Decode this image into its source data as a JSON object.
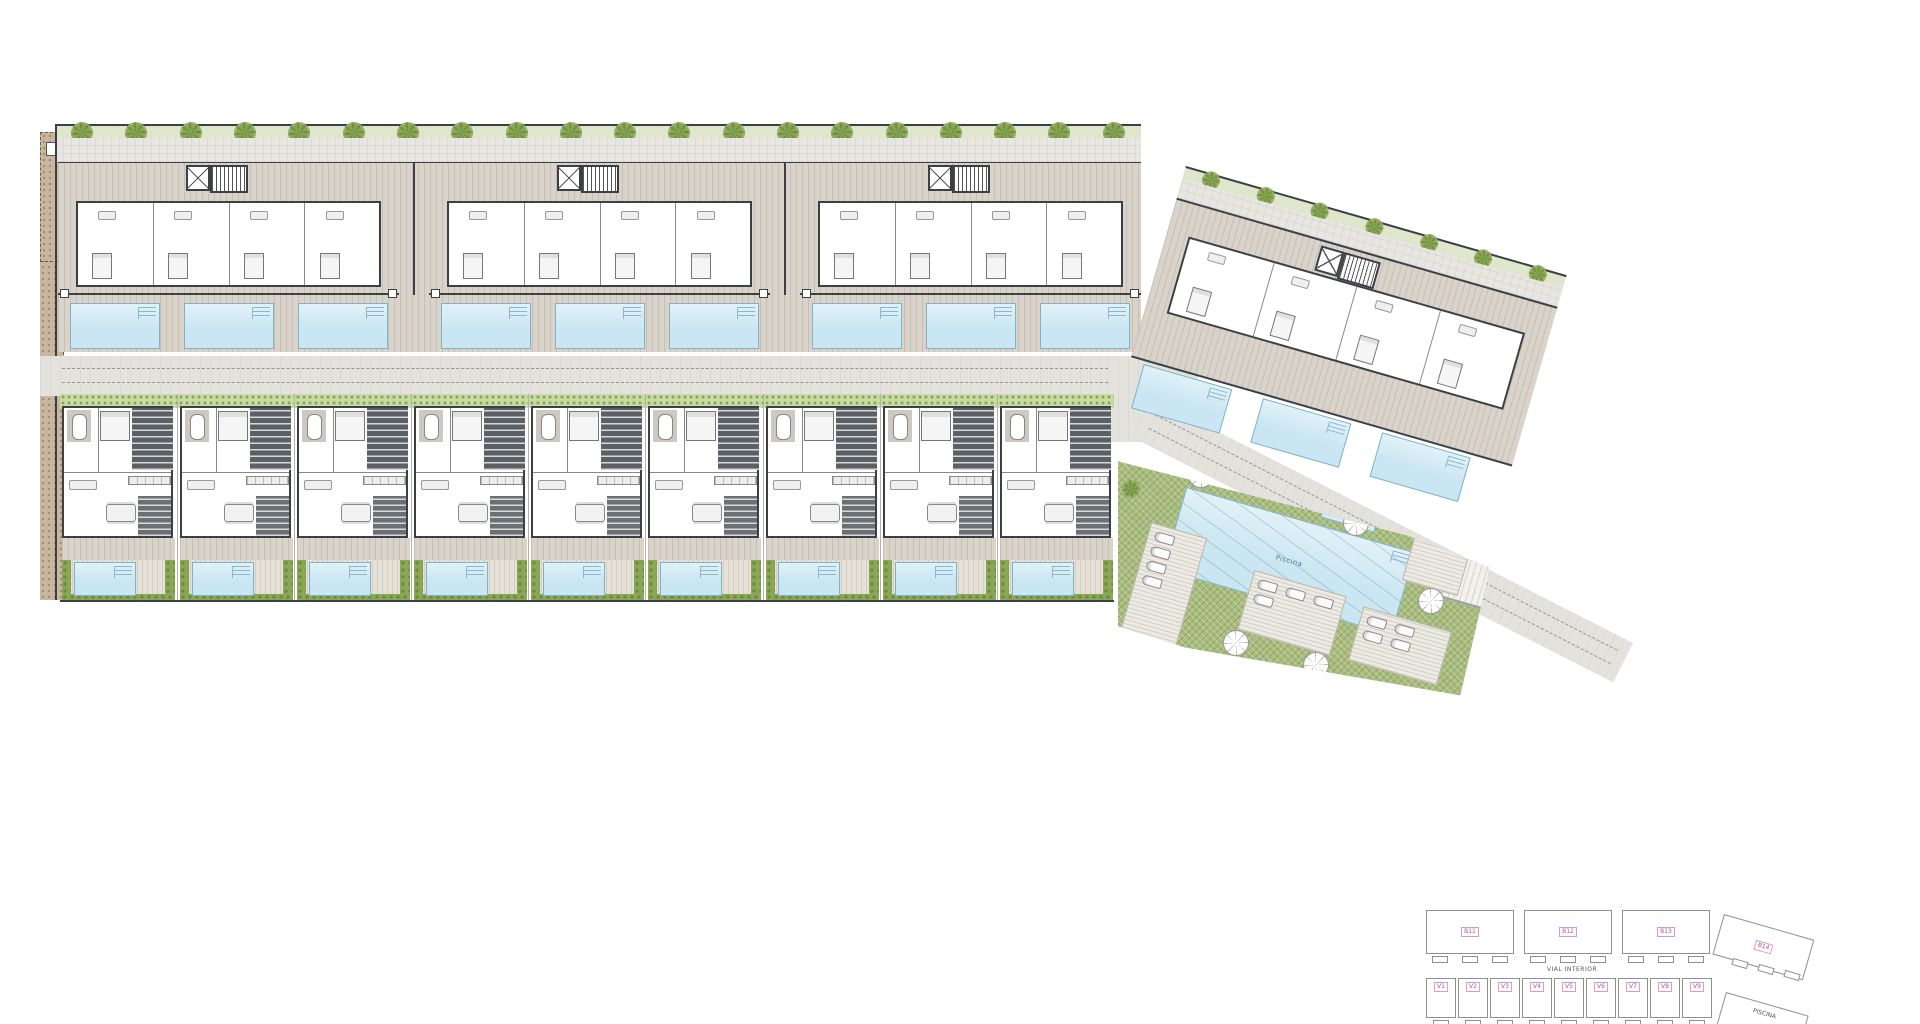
{
  "palette": {
    "deck": "#d9d3c9",
    "paving": "#e8e6e1",
    "wall_dark": "#3b4046",
    "pool_water": "#c9e6f2",
    "pool_edge": "#7fb3c9",
    "hedge_green": "#8aa757",
    "lawn_green": "#a8bc7d",
    "road_grey": "#e4e2dd",
    "earth_tan": "#c8b69e",
    "key_label_pink": "#b3509c"
  },
  "main_plan": {
    "communal": {
      "main_pool_label": "Piscina",
      "kids_pool_label_line1": "Piscina",
      "kids_pool_label_line2": "infantil"
    }
  },
  "key_plan": {
    "block_labels": [
      "B11",
      "B12",
      "B13"
    ],
    "right_block_label": "B14",
    "road_label": "VIAL INTERIOR",
    "villa_labels": [
      "V1",
      "V2",
      "V3",
      "V4",
      "V5",
      "V6",
      "V7",
      "V8",
      "V9"
    ],
    "communal_label": "PISCINA"
  },
  "counts": {
    "apartment_blocks": 3,
    "villas": 9,
    "pools_per_block": 3,
    "right_block_pools": 3,
    "perimeter_trees": 20,
    "right_hedge_trees": 7,
    "parasols": 6,
    "lounger_decks": 4
  }
}
